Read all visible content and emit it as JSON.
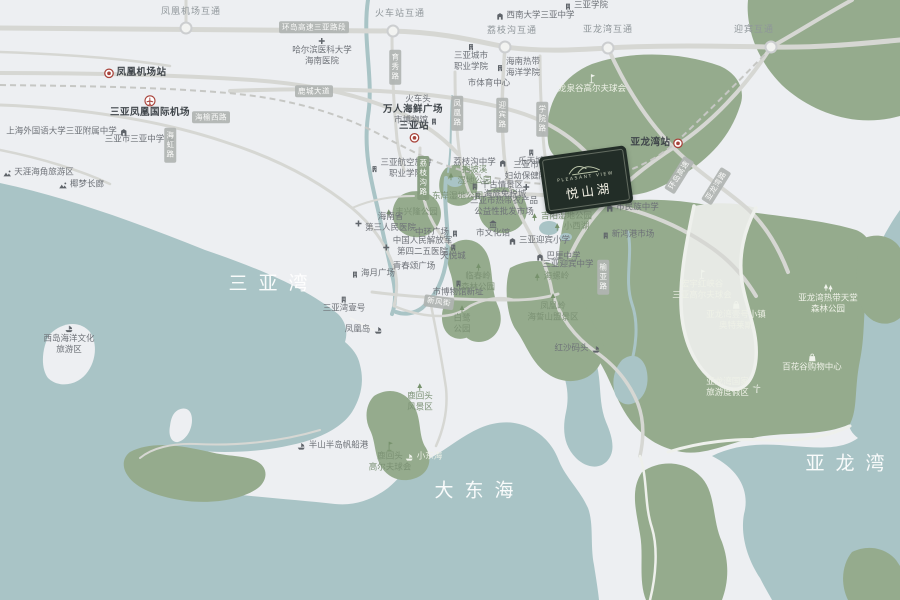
{
  "map": {
    "colors": {
      "sea": "#a9c4c6",
      "land": "#edeff2",
      "park": "#95ab8d",
      "road": "#d6d7d3",
      "road_on_park": "#eef0ec",
      "rail": "#c6c7c4",
      "label": "#6e7278",
      "label_dark": "#3f454a",
      "label_on_park": "#eef1e7",
      "park_label": "#7b9174",
      "station_red": "#a8433b",
      "road_box": "#b0b4b2",
      "road_box_green": "#869c7e",
      "project_bg": "#222d27",
      "project_text": "#f4f2e6"
    },
    "project": {
      "name_en": "PLEASANT VIEW",
      "name_cn": "悦山湖",
      "x": 586,
      "y": 180,
      "rotate": -8
    },
    "interchanges": [
      {
        "id": "interchange-fenghuang-airport",
        "x": 191,
        "y": 13,
        "lines": [
          "凤凰机场互通"
        ],
        "node": [
          186,
          28
        ]
      },
      {
        "id": "interchange-railway-station",
        "x": 400,
        "y": 15,
        "lines": [
          "火车站互通"
        ],
        "node": [
          393,
          31
        ]
      },
      {
        "id": "interchange-lizhigou",
        "x": 512,
        "y": 32,
        "lines": [
          "荔枝沟互通"
        ],
        "node": [
          505,
          47
        ]
      },
      {
        "id": "interchange-yalongwan",
        "x": 608,
        "y": 31,
        "lines": [
          "亚龙湾互通"
        ],
        "node": [
          608,
          48
        ]
      },
      {
        "id": "interchange-yingbin",
        "x": 754,
        "y": 31,
        "lines": [
          "迎宾互通"
        ],
        "node": [
          771,
          47
        ]
      }
    ],
    "pois": [
      {
        "id": "station-fenghuang-airport",
        "x": 135,
        "y": 73,
        "lines": [
          "凤凰机场站"
        ],
        "icon": "metro-icon",
        "icon_pos": "left",
        "style": "bold"
      },
      {
        "id": "poi-sanya-airport",
        "x": 150,
        "y": 107,
        "lines": [
          "三亚凤凰国际机场"
        ],
        "icon": "plane-icon",
        "icon_pos": "top",
        "style": "bold"
      },
      {
        "id": "station-sanya",
        "x": 414,
        "y": 132,
        "lines": [
          "三亚站"
        ],
        "icon": "metro-icon",
        "icon_pos": "bottom",
        "style": "bold"
      },
      {
        "id": "station-yalongwan",
        "x": 657,
        "y": 143,
        "lines": [
          "亚龙湾站"
        ],
        "icon": "metro-icon",
        "icon_pos": "right",
        "style": "bold"
      },
      {
        "id": "poi-jiyang-government",
        "x": 604,
        "y": 196,
        "lines": [
          "吉阳区政府"
        ],
        "icon": "star-icon",
        "icon_pos": "bottom",
        "style": "bold"
      },
      {
        "id": "poi-shanghai-foreign-school",
        "x": 67,
        "y": 132,
        "lines": [
          "上海外国语大学三亚附属中学"
        ],
        "icon": "school-icon",
        "icon_pos": "right"
      },
      {
        "id": "poi-sanya-middle-school",
        "x": 140,
        "y": 140,
        "lines": [
          "三亚市三亚中学"
        ],
        "icon": "school-icon",
        "icon_pos": "right"
      },
      {
        "id": "poi-tianya-haijiao",
        "x": 38,
        "y": 173,
        "lines": [
          "天涯海角旅游区"
        ],
        "icon": "scenic-icon",
        "icon_pos": "left"
      },
      {
        "id": "poi-yemeng-corridor",
        "x": 81,
        "y": 185,
        "lines": [
          "椰梦长廊"
        ],
        "icon": "scenic-icon",
        "icon_pos": "left"
      },
      {
        "id": "poi-sanya-university",
        "x": 586,
        "y": 6,
        "lines": [
          "三亚学院"
        ],
        "icon": "building-icon",
        "icon_pos": "left"
      },
      {
        "id": "poi-southwest-univ-school",
        "x": 535,
        "y": 16,
        "lines": [
          "西南大学三亚中学"
        ],
        "icon": "school-icon",
        "icon_pos": "left"
      },
      {
        "id": "poi-harbin-medical",
        "x": 322,
        "y": 52,
        "lines": [
          "哈尔滨医科大学",
          "海南医院"
        ],
        "icon": "cross-icon",
        "icon_pos": "top"
      },
      {
        "id": "poi-city-vocational-college",
        "x": 471,
        "y": 58,
        "lines": [
          "三亚城市",
          "职业学院"
        ],
        "icon": "building-icon",
        "icon_pos": "top"
      },
      {
        "id": "poi-tropical-ocean-univ",
        "x": 518,
        "y": 68,
        "lines": [
          "海南热带",
          "海洋学院"
        ],
        "icon": "building-icon",
        "icon_pos": "left"
      },
      {
        "id": "poi-sports-center",
        "x": 489,
        "y": 84,
        "lines": [
          "市体育中心"
        ]
      },
      {
        "id": "poi-train-head",
        "x": 418,
        "y": 100,
        "lines": [
          "火车头"
        ]
      },
      {
        "id": "poi-wanren-seafood-plaza",
        "x": 413,
        "y": 110,
        "lines": [
          "万人海鲜广场"
        ],
        "style": "bold"
      },
      {
        "id": "poi-city-museum",
        "x": 416,
        "y": 121,
        "lines": [
          "市博物馆"
        ],
        "icon": "building-icon",
        "icon_pos": "right"
      },
      {
        "id": "poi-aviation-college",
        "x": 401,
        "y": 169,
        "lines": [
          "三亚航空旅游",
          "职业学院"
        ],
        "icon": "building-icon",
        "icon_pos": "left"
      },
      {
        "id": "poi-lizhigou-school",
        "x": 480,
        "y": 163,
        "lines": [
          "荔枝沟中学"
        ],
        "icon": "school-icon",
        "icon_pos": "right"
      },
      {
        "id": "poi-lotte-town",
        "x": 531,
        "y": 158,
        "lines": [
          "乐天城"
        ],
        "icon": "building-icon",
        "icon_pos": "top"
      },
      {
        "id": "poi-maternity-hospital",
        "x": 526,
        "y": 176,
        "lines": [
          "三亚市",
          "妇幼保健院"
        ],
        "icon": "cross-icon",
        "icon_pos": "bottom"
      },
      {
        "id": "poi-qiangu-scenic",
        "x": 497,
        "y": 186,
        "lines": [
          "千古情景区"
        ],
        "icon": "building-icon",
        "icon_pos": "left"
      },
      {
        "id": "poi-hailv-duty-free",
        "x": 500,
        "y": 195,
        "lines": [
          "海旅免税城"
        ],
        "icon": "building-icon",
        "icon_pos": "left"
      },
      {
        "id": "poi-wholesale-market",
        "x": 504,
        "y": 207,
        "lines": [
          "三亚市热带农产品",
          "公益性批发市场"
        ]
      },
      {
        "id": "poi-cultural-center",
        "x": 493,
        "y": 229,
        "lines": [
          "市文化馆"
        ],
        "icon": "bank-icon",
        "icon_pos": "top"
      },
      {
        "id": "poi-dongan-wetland-park",
        "x": 452,
        "y": 197,
        "lines": [
          "东岸湿地公园"
        ],
        "icon": "tree-icon",
        "icon_pos": "left",
        "style": "park"
      },
      {
        "id": "poi-baopoxi-wetland-park",
        "x": 469,
        "y": 176,
        "lines": [
          "抱坡溪",
          "湿地公园"
        ],
        "icon": "tree-icon",
        "icon_pos": "left",
        "style": "park"
      },
      {
        "id": "poi-fengxinglong-park",
        "x": 411,
        "y": 213,
        "lines": [
          "丰兴隆公园"
        ],
        "icon": "tree-icon",
        "icon_pos": "left",
        "style": "park"
      },
      {
        "id": "poi-third-people-hospital",
        "x": 385,
        "y": 223,
        "lines": [
          "海南省",
          "第三人民医院"
        ],
        "icon": "cross-icon",
        "icon_pos": "left"
      },
      {
        "id": "poi-zhonghuan-plaza",
        "x": 437,
        "y": 233,
        "lines": [
          "中环广场"
        ],
        "icon": "building-icon",
        "icon_pos": "right"
      },
      {
        "id": "poi-navy-hospital",
        "x": 417,
        "y": 247,
        "lines": [
          "中国人民解放军",
          "第四二五医院"
        ],
        "icon": "cross-icon",
        "icon_pos": "left"
      },
      {
        "id": "poi-tianyue-mall",
        "x": 453,
        "y": 253,
        "lines": [
          "天悦城"
        ],
        "icon": "building-icon",
        "icon_pos": "top"
      },
      {
        "id": "poi-qingchun-plaza",
        "x": 414,
        "y": 267,
        "lines": [
          "青春颂广场"
        ]
      },
      {
        "id": "poi-haiyue-plaza",
        "x": 373,
        "y": 274,
        "lines": [
          "海月广场"
        ],
        "icon": "building-icon",
        "icon_pos": "left"
      },
      {
        "id": "poi-sanyawan-no1",
        "x": 344,
        "y": 305,
        "lines": [
          "三亚湾壹号"
        ],
        "icon": "building-icon",
        "icon_pos": "top"
      },
      {
        "id": "poi-museum-new-site",
        "x": 458,
        "y": 289,
        "lines": [
          "市博物馆新址"
        ],
        "icon": "building-icon",
        "icon_pos": "top"
      },
      {
        "id": "poi-phoenix-island",
        "x": 364,
        "y": 330,
        "lines": [
          "凤凰岛"
        ],
        "icon": "ship-icon",
        "icon_pos": "right"
      },
      {
        "id": "poi-west-island",
        "x": 69,
        "y": 340,
        "lines": [
          "西岛海洋文化",
          "旅游区"
        ],
        "icon": "ship-icon",
        "icon_pos": "top"
      },
      {
        "id": "poi-egret-park",
        "x": 462,
        "y": 320,
        "lines": [
          "白鹭",
          "公园"
        ],
        "icon": "tree-icon",
        "icon_pos": "top",
        "style": "park"
      },
      {
        "id": "poi-linchunling-forest-park",
        "x": 478,
        "y": 278,
        "lines": [
          "临春岭",
          "森林公园"
        ],
        "icon": "tree-icon",
        "icon_pos": "top",
        "style": "park"
      },
      {
        "id": "poi-fenghuangling-scenic",
        "x": 553,
        "y": 308,
        "lines": [
          "凤凰岭",
          "海誓山盟景区"
        ],
        "icon": "tree-icon",
        "icon_pos": "top",
        "style": "park"
      },
      {
        "id": "poi-hongsha-pier",
        "x": 578,
        "y": 349,
        "lines": [
          "红沙码头"
        ],
        "icon": "ship-icon",
        "icon_pos": "right"
      },
      {
        "id": "poi-luhuitou-scenic",
        "x": 420,
        "y": 398,
        "lines": [
          "鹿回头",
          "风景区"
        ],
        "icon": "tree-icon",
        "icon_pos": "top",
        "style": "park"
      },
      {
        "id": "poi-banshan-marina",
        "x": 332,
        "y": 446,
        "lines": [
          "半山半岛帆船港"
        ],
        "icon": "ship-icon",
        "icon_pos": "left"
      },
      {
        "id": "poi-luhuitou-golf",
        "x": 390,
        "y": 457,
        "lines": [
          "鹿回头",
          "高尔夫球会"
        ],
        "icon": "golf-icon",
        "icon_pos": "top",
        "style": "park"
      },
      {
        "id": "poi-xiaodonghai",
        "x": 423,
        "y": 457,
        "lines": [
          "小东海"
        ],
        "icon": "ship-icon",
        "icon_pos": "left",
        "style": "on-park"
      },
      {
        "id": "poi-minzu-school",
        "x": 632,
        "y": 208,
        "lines": [
          "市民族中学"
        ],
        "icon": "school-icon",
        "icon_pos": "left"
      },
      {
        "id": "poi-xinhonggang-market",
        "x": 628,
        "y": 235,
        "lines": [
          "新鸿港市场"
        ],
        "icon": "building-icon",
        "icon_pos": "left"
      },
      {
        "id": "poi-jiyang-wetland-park",
        "x": 561,
        "y": 217,
        "lines": [
          "吉阳湿地公园"
        ],
        "icon": "tree-icon",
        "icon_pos": "left",
        "style": "park"
      },
      {
        "id": "poi-xiaoxihu",
        "x": 571,
        "y": 227,
        "lines": [
          "小西湖"
        ],
        "icon": "tree-icon",
        "icon_pos": "left",
        "style": "park"
      },
      {
        "id": "poi-yingbin-primary-school",
        "x": 539,
        "y": 241,
        "lines": [
          "三亚迎宾小学"
        ],
        "icon": "school-icon",
        "icon_pos": "left"
      },
      {
        "id": "poi-bali-school",
        "x": 558,
        "y": 257,
        "lines": [
          "巴厘中学"
        ],
        "icon": "school-icon",
        "icon_pos": "left"
      },
      {
        "id": "poi-yingbin-middle-school",
        "x": 568,
        "y": 265,
        "lines": [
          "三亚迎宾中学"
        ]
      },
      {
        "id": "poi-hailuoling",
        "x": 551,
        "y": 277,
        "lines": [
          "海螺岭"
        ],
        "icon": "tree-icon",
        "icon_pos": "left",
        "style": "park"
      },
      {
        "id": "poi-longquangu-golf",
        "x": 592,
        "y": 84,
        "lines": [
          "龙泉谷高尔夫球会"
        ],
        "icon": "golf-icon",
        "icon_pos": "top",
        "style": "on-park"
      },
      {
        "id": "poi-hongxiagu-golf",
        "x": 702,
        "y": 285,
        "lines": [
          "宏宇红峡谷",
          "三亚高尔夫球会"
        ],
        "icon": "golf-icon",
        "icon_pos": "top",
        "style": "on-park"
      },
      {
        "id": "poi-yalongwan-no1-outlets",
        "x": 736,
        "y": 316,
        "lines": [
          "亚龙湾壹号小镇",
          "奥特莱斯"
        ],
        "icon": "bag-icon",
        "icon_pos": "top",
        "style": "on-park"
      },
      {
        "id": "poi-tropical-paradise-forest-park",
        "x": 828,
        "y": 299,
        "lines": [
          "亚龙湾热带天堂",
          "森林公园"
        ],
        "icon": "trees-icon",
        "icon_pos": "top",
        "style": "on-park"
      },
      {
        "id": "poi-baihuagu-mall",
        "x": 812,
        "y": 363,
        "lines": [
          "百花谷购物中心"
        ],
        "icon": "bag-icon",
        "icon_pos": "top",
        "style": "on-park"
      },
      {
        "id": "poi-yalongwan-resort",
        "x": 734,
        "y": 388,
        "lines": [
          "亚龙湾国家",
          "旅游度假区"
        ],
        "icon": "palm-icon",
        "icon_pos": "right",
        "style": "on-park"
      },
      {
        "id": "sea-sanya-bay",
        "x": 268,
        "y": 284,
        "lines": [
          "三亚湾"
        ],
        "style": "sea"
      },
      {
        "id": "sea-dadonghai",
        "x": 474,
        "y": 491,
        "lines": [
          "大东海"
        ],
        "style": "sea"
      },
      {
        "id": "sea-yalong-bay",
        "x": 845,
        "y": 464,
        "lines": [
          "亚龙湾"
        ],
        "style": "sea"
      }
    ],
    "road_labels": [
      {
        "id": "road-huandao-expressway-sanya",
        "x": 314,
        "y": 27,
        "text": "环岛高速三亚路段"
      },
      {
        "id": "road-haiyu-west",
        "x": 211,
        "y": 117,
        "text": "海榆西路"
      },
      {
        "id": "road-lucheng-avenue",
        "x": 314,
        "y": 91,
        "text": "鹿城大道"
      },
      {
        "id": "road-haihong",
        "x": 170,
        "y": 145,
        "text": "海虹路",
        "vertical": true
      },
      {
        "id": "road-yuxiu",
        "x": 395,
        "y": 67,
        "text": "育秀路",
        "vertical": true
      },
      {
        "id": "road-fenghuang",
        "x": 457,
        "y": 113,
        "text": "凤凰路",
        "vertical": true
      },
      {
        "id": "road-yingbin",
        "x": 502,
        "y": 115,
        "text": "迎宾路",
        "vertical": true
      },
      {
        "id": "road-xueyuan",
        "x": 542,
        "y": 119,
        "text": "学院路",
        "vertical": true
      },
      {
        "id": "road-lizhigou",
        "x": 423,
        "y": 178,
        "text": "荔枝沟路",
        "vertical": true,
        "green": true
      },
      {
        "id": "road-jiyang-avenue",
        "x": 569,
        "y": 196,
        "text": "吉阳大道",
        "rotate": 18
      },
      {
        "id": "road-xinfeng-street",
        "x": 439,
        "y": 302,
        "text": "新风街",
        "rotate": 8
      },
      {
        "id": "road-yuya",
        "x": 603,
        "y": 277,
        "text": "榆亚路",
        "vertical": true
      },
      {
        "id": "road-huandao-expressway",
        "x": 679,
        "y": 175,
        "text": "环岛高速",
        "rotate": -58
      },
      {
        "id": "road-yalongwan",
        "x": 716,
        "y": 186,
        "text": "亚龙湾路",
        "rotate": -58
      }
    ]
  }
}
